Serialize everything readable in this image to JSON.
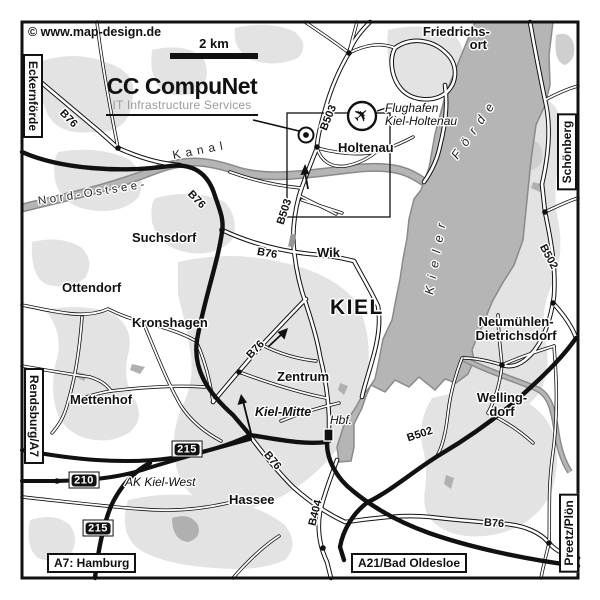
{
  "colors": {
    "water": "#b5b5b5",
    "urban": "#e3e3e3",
    "urban_dark": "#cfcfcf",
    "canal_edge": "#8a8a8a",
    "line_black": "#111111",
    "logo_gray": "#9b9b9b"
  },
  "branding": {
    "copyright": "© www.map-design.de",
    "scale_label": "2 km",
    "title": "CC CompuNet",
    "subtitle": "IT Infrastructure Services"
  },
  "edge_labels": {
    "left_top": "Eckernförde",
    "left_bottom": "Rendsburg/A7",
    "right_top": "Schönberg",
    "right_bottom": "Preetz/Plön",
    "bottom_left": "A7: Hamburg",
    "bottom_right": "A21/Bad Oldesloe"
  },
  "places": {
    "friedrichsort_line1": "Friedrichs-",
    "friedrichsort_line2": "ort",
    "holtenau": "Holtenau",
    "suchsdorf": "Suchsdorf",
    "wik": "Wik",
    "kiel": "KIEL",
    "ottendorf": "Ottendorf",
    "kronshagen": "Kronshagen",
    "zentrum": "Zentrum",
    "neumuehlen_line1": "Neumühlen-",
    "neumuehlen_line2": "Dietrichsdorf",
    "mettenhof": "Mettenhof",
    "hassee": "Hassee",
    "wellingdorf_line1": "Welling-",
    "wellingdorf_line2": "dorf",
    "kiel_mitte": "Kiel-Mitte",
    "hbf": "Hbf.",
    "ak_kiel_west": "AK Kiel-West",
    "airport_line1": "Flughafen",
    "airport_line2": "Kiel-Holtenau"
  },
  "road_labels": {
    "b76": "B76",
    "b503": "B503",
    "b502": "B502",
    "b404": "B404",
    "shield_215": "215",
    "shield_210": "210"
  },
  "waterways": {
    "kanal": "Kanal",
    "nord_ostsee": "Nord-Ostsee-",
    "kieler": "Kieler",
    "foerde": "Förde"
  },
  "icons": {
    "airplane_glyph": "✈"
  }
}
